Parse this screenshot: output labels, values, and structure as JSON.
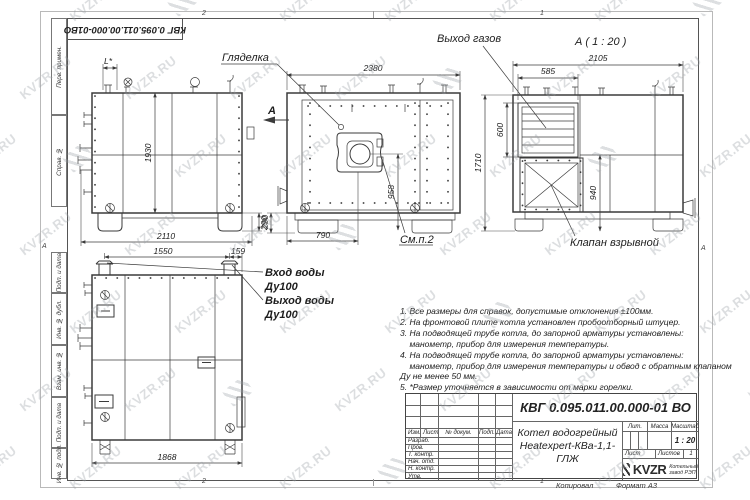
{
  "watermark": {
    "text": "KVZR.RU"
  },
  "frame": {
    "corner_stamp": "КВГ 0.095.011.00.000-01ВО",
    "zones": {
      "top_left": "2",
      "top_right": "1",
      "bottom_left": "2",
      "bottom_right": "1",
      "left": "А",
      "right": "А"
    },
    "side_labels": [
      "Перв. примен.",
      "Справ. №",
      "Подп. и дата",
      "Инв. № дубл.",
      "Взам. инв. №",
      "Подп. и дата",
      "Инв. № подл."
    ],
    "copied_label": "Копировал",
    "format_label": "Формат А3"
  },
  "views": {
    "side": {
      "dim_top": "L*",
      "dim_height": "1930",
      "dim_width": "2110",
      "dim_base": "290"
    },
    "front": {
      "sight_label": "Гляделка",
      "see_note": "См.п.2",
      "arrow_label": "А",
      "dim_width": "2380",
      "dim_burner": "958",
      "dim_pipe": "290",
      "dim_burner_x": "790"
    },
    "gas": {
      "title": "А ( 1 : 20 )",
      "gas_label": "Выход газов",
      "valve_label": "Клапан взрывной",
      "dim_width": "2105",
      "dim_louver_w": "585",
      "dim_louver_h": "600",
      "dim_height": "1710",
      "dim_valve": "940"
    },
    "rear": {
      "inlet_line1": "Вход воды",
      "inlet_line2": "Ду100",
      "outlet_line1": "Выход воды",
      "outlet_line2": "Ду100",
      "dim_pipes": "1550",
      "dim_offset": "159",
      "dim_width": "1868"
    }
  },
  "notes": {
    "lines": [
      "1. Все размеры для справок, допустимые отклонения ±100мм.",
      "2. На фронтовой плите котла установлен пробоотборный штуцер.",
      "3. На подводящей трубе котла, до запорной арматуры установлены:",
      "    манометр, прибор для измерения температуры.",
      "4. На подводящей трубе котла, до запорной арматуры установлены:",
      "    манометр, прибор для измерения температуры и обвод с обратным клапаном",
      "Ду не менее 50 мм.",
      "5. *Размер уточняется в зависимости от марки горелки."
    ]
  },
  "title_block": {
    "designation": "КВГ 0.095.011.00.000-01 ВО",
    "product_name_1": "Котел водогрейный",
    "product_name_2": "Heatexpert-КВа-1,1-ГЛЖ",
    "col_izm": "Изм.",
    "col_list": "Лист",
    "col_doc": "№ докум.",
    "col_sign": "Подп.",
    "col_date": "Дата",
    "rows": [
      "Разраб.",
      "Пров.",
      "Т. контр.",
      "Нач. отд.",
      "Н. контр.",
      "Утв."
    ],
    "lit_label": "Лит.",
    "mass_label": "Масса",
    "scale_label": "Масштаб",
    "scale_value": "1 : 20",
    "sheet_label": "Лист",
    "sheets_label": "Листов",
    "sheets_value": "1",
    "copy_num": "1",
    "company_logo": "KVZR",
    "company_name_1": "Котельный",
    "company_name_2": "завод РЭП"
  }
}
